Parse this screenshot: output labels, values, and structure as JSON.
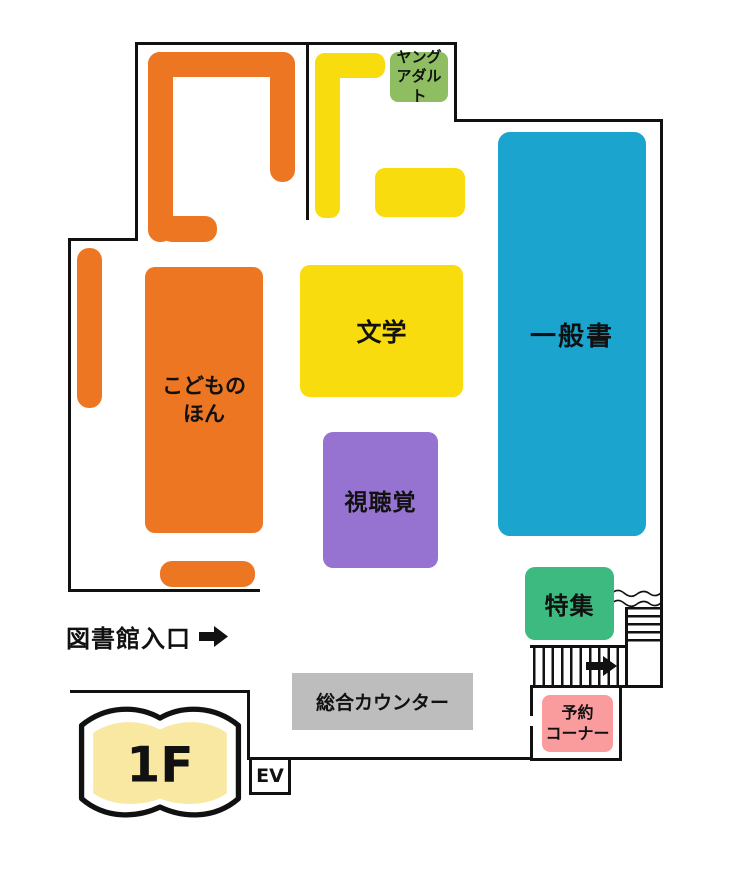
{
  "colors": {
    "orange": "#ED7622",
    "yellow": "#F9DC0E",
    "blue": "#1AA4CE",
    "purple": "#9773D1",
    "green": "#3CBA80",
    "light_green": "#8FBE62",
    "pink": "#FA9B9E",
    "gray": "#BDBDBD",
    "cream": "#F9E8A2",
    "outline": "#111111"
  },
  "floor_badge": {
    "label": "1F"
  },
  "entrance": {
    "label": "図書館入口"
  },
  "elevator": {
    "label": "EV"
  },
  "areas": {
    "children_books": {
      "label": "こどもの\nほん"
    },
    "literature": {
      "label": "文学"
    },
    "general_books": {
      "label": "一般書"
    },
    "audio_visual": {
      "label": "視聴覚"
    },
    "special_feature": {
      "label": "特集"
    },
    "young_adult": {
      "label": "ヤング\nアダルト"
    },
    "main_counter": {
      "label": "総合カウンター"
    },
    "reservation_corner": {
      "label": "予約\nコーナー"
    }
  }
}
